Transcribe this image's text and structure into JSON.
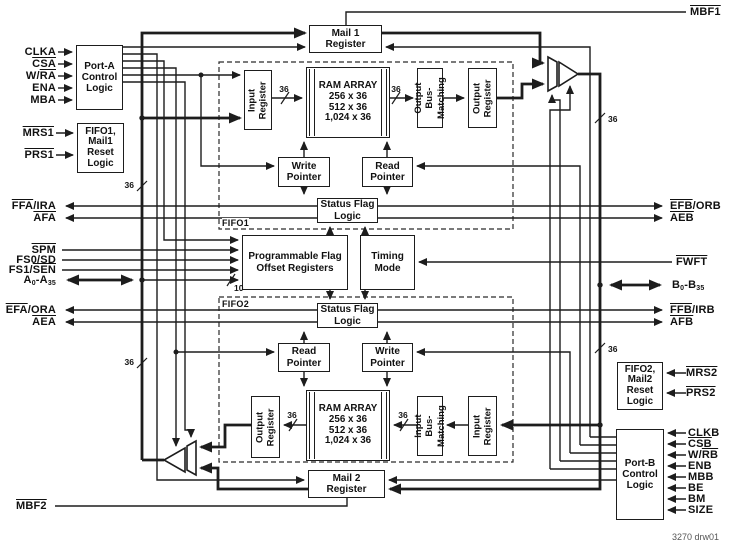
{
  "figure": {
    "caption": "3270 drw01"
  },
  "regions": {
    "fifo1": "FIFO1",
    "fifo2": "FIFO2"
  },
  "bus_widths": {
    "w36": "36",
    "w10": "10"
  },
  "boxes": {
    "port_a": "Port-A\nControl\nLogic",
    "reset1": "FIFO1,\nMail1\nReset\nLogic",
    "mail1": "Mail 1\nRegister",
    "input_reg1": "Input\nRegister",
    "ram1": "RAM ARRAY\n256 x 36\n512 x 36\n1,024 x 36",
    "out_bus_match": "Output Bus-\nMatching",
    "out_reg1": "Output\nRegister",
    "write_ptr1": "Write\nPointer",
    "read_ptr1": "Read\nPointer",
    "status1": "Status Flag\nLogic",
    "pfo": "Programmable Flag\nOffset Registers",
    "timing": "Timing\nMode",
    "status2": "Status Flag\nLogic",
    "read_ptr2": "Read\nPointer",
    "write_ptr2": "Write\nPointer",
    "out_reg2": "Output\nRegister",
    "ram2": "RAM ARRAY\n256 x 36\n512 x 36\n1,024 x 36",
    "in_bus_match": "Input Bus-\nMatching",
    "input_reg2": "Input\nRegister",
    "mail2": "Mail 2\nRegister",
    "reset2": "FIFO2,\nMail2\nReset\nLogic",
    "port_b": "Port-B\nControl\nLogic"
  },
  "signals": {
    "clka": [
      {
        "t": "CLKA"
      }
    ],
    "csa": [
      {
        "t": "CSA",
        "ov": true
      }
    ],
    "wra": [
      {
        "t": "W/"
      },
      {
        "t": "RA",
        "ov": true
      }
    ],
    "ena": [
      {
        "t": "ENA"
      }
    ],
    "mba": [
      {
        "t": "MBA"
      }
    ],
    "mrs1": [
      {
        "t": "MRS1",
        "ov": true
      }
    ],
    "prs1": [
      {
        "t": "PRS1",
        "ov": true
      }
    ],
    "ffa_ira": [
      {
        "t": "FFA",
        "ov": true
      },
      {
        "t": "/IRA"
      }
    ],
    "afa": [
      {
        "t": "AFA",
        "ov": true
      }
    ],
    "spm": [
      {
        "t": "SPM",
        "ov": true
      }
    ],
    "fs0_sd": [
      {
        "t": "FS0/SD"
      }
    ],
    "fs1_sen": [
      {
        "t": "FS1/"
      },
      {
        "t": "SEN",
        "ov": true
      }
    ],
    "a_bus": [
      {
        "t": "A"
      },
      {
        "t": "0",
        "sub": true
      },
      {
        "t": "-A"
      },
      {
        "t": "35",
        "sub": true
      }
    ],
    "efa_ora": [
      {
        "t": "EFA",
        "ov": true
      },
      {
        "t": "/ORA"
      }
    ],
    "aea": [
      {
        "t": "AEA",
        "ov": true
      }
    ],
    "mbf2": [
      {
        "t": "MBF2",
        "ov": true
      }
    ],
    "mbf1": [
      {
        "t": "MBF1",
        "ov": true
      }
    ],
    "efb_orb": [
      {
        "t": "EFB",
        "ov": true
      },
      {
        "t": "/ORB"
      }
    ],
    "aeb": [
      {
        "t": "AEB",
        "ov": true
      }
    ],
    "fwft": [
      {
        "t": "FWFT",
        "ov": true
      }
    ],
    "b_bus": [
      {
        "t": "B"
      },
      {
        "t": "0",
        "sub": true
      },
      {
        "t": "-B"
      },
      {
        "t": "35",
        "sub": true
      }
    ],
    "ffb_irb": [
      {
        "t": "FFB",
        "ov": true
      },
      {
        "t": "/IRB"
      }
    ],
    "afb": [
      {
        "t": "AFB",
        "ov": true
      }
    ],
    "mrs2": [
      {
        "t": "MRS2",
        "ov": true
      }
    ],
    "prs2": [
      {
        "t": "PRS2",
        "ov": true
      }
    ],
    "clkb": [
      {
        "t": "CLKB"
      }
    ],
    "csb": [
      {
        "t": "CSB",
        "ov": true
      }
    ],
    "wrb": [
      {
        "t": "W/"
      },
      {
        "t": "RB",
        "ov": true
      }
    ],
    "enb": [
      {
        "t": "ENB"
      }
    ],
    "mbb": [
      {
        "t": "MBB"
      }
    ],
    "be": [
      {
        "t": "BE"
      }
    ],
    "bm": [
      {
        "t": "BM"
      }
    ],
    "size": [
      {
        "t": "SIZE"
      }
    ]
  }
}
